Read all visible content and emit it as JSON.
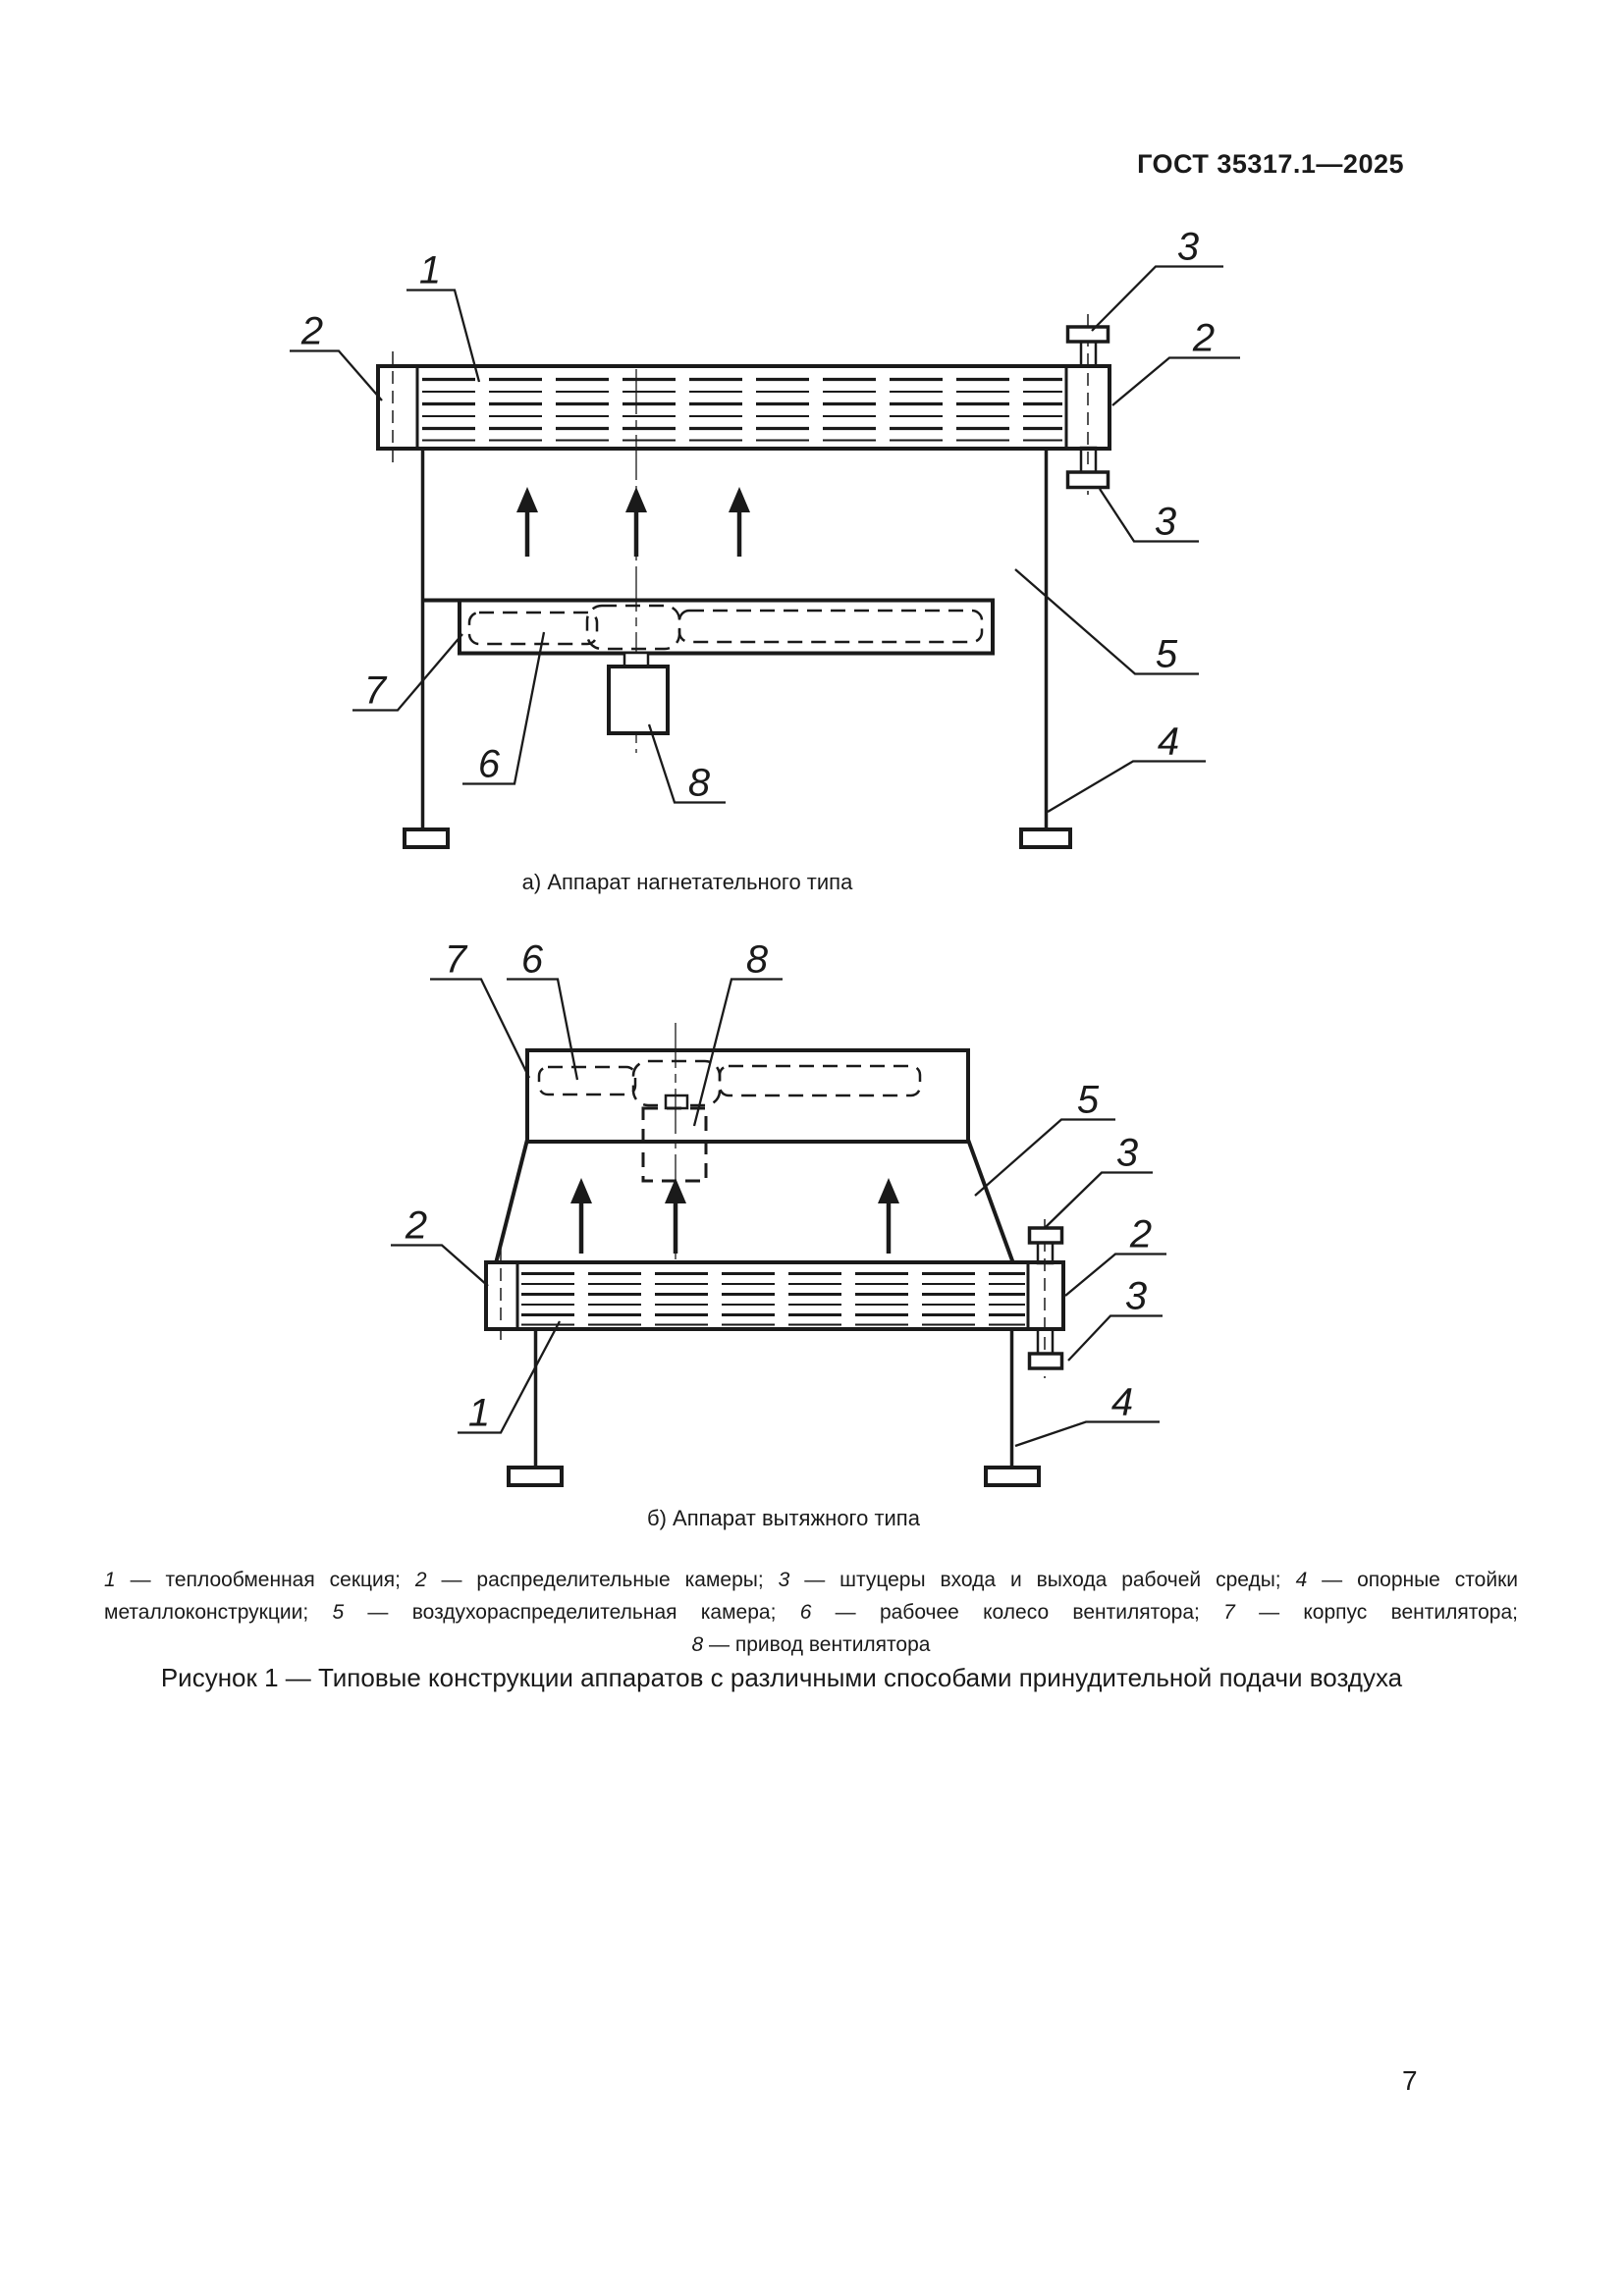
{
  "header": {
    "title": "ГОСТ 35317.1—2025"
  },
  "colors": {
    "ink": "#1a1a1a",
    "paper": "#ffffff"
  },
  "diagram_a": {
    "caption": "а) Аппарат нагнетательного типа",
    "callouts": [
      {
        "label": "1"
      },
      {
        "label": "2"
      },
      {
        "label": "3"
      },
      {
        "label": "2"
      },
      {
        "label": "3"
      },
      {
        "label": "5"
      },
      {
        "label": "4"
      },
      {
        "label": "7"
      },
      {
        "label": "6"
      },
      {
        "label": "8"
      }
    ]
  },
  "diagram_b": {
    "caption": "б) Аппарат вытяжного типа",
    "callouts": [
      {
        "label": "7"
      },
      {
        "label": "6"
      },
      {
        "label": "8"
      },
      {
        "label": "5"
      },
      {
        "label": "3"
      },
      {
        "label": "2"
      },
      {
        "label": "3"
      },
      {
        "label": "2"
      },
      {
        "label": "1"
      },
      {
        "label": "4"
      }
    ]
  },
  "legend": {
    "line1": [
      {
        "num": "1",
        "rest": " — теплообменная секция; "
      },
      {
        "num": "2",
        "rest": " — распределительные камеры; "
      },
      {
        "num": "3",
        "rest": " — штуцеры входа и выхода рабочей среды; "
      },
      {
        "num": "4",
        "rest": " — опорные стойки"
      }
    ],
    "line2_prefix": "металлоконструкции; ",
    "line2": [
      {
        "num": "5",
        "rest": " — воздухораспределительная камера; "
      },
      {
        "num": "6",
        "rest": " — рабочее колесо вентилятора; "
      },
      {
        "num": "7",
        "rest": " — корпус вентилятора;"
      }
    ],
    "line3": [
      {
        "num": "8",
        "rest": " — привод вентилятора"
      }
    ]
  },
  "figure": {
    "caption": "Рисунок 1 — Типовые конструкции аппаратов с различными способами принудительной подачи воздуха"
  },
  "footer": {
    "page_number": "7"
  }
}
